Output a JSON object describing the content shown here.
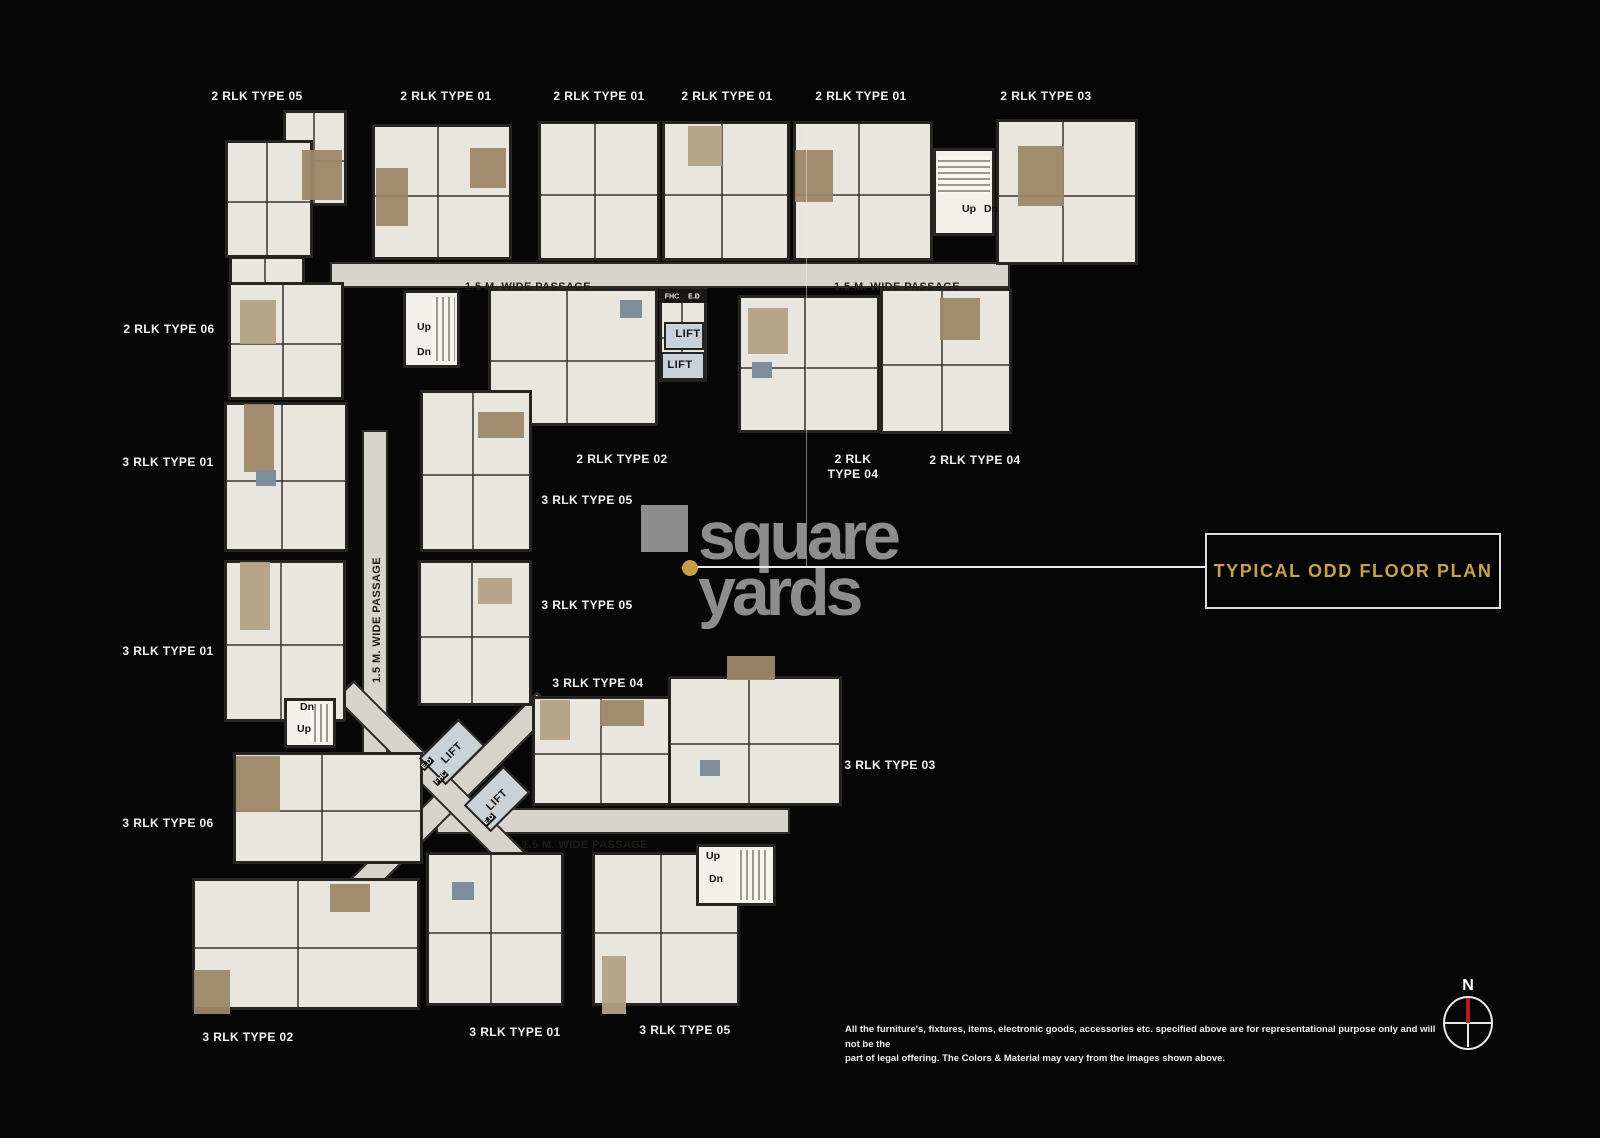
{
  "callout": {
    "title": "TYPICAL ODD FLOOR PLAN"
  },
  "watermark": {
    "word1": "square",
    "word2": "yards"
  },
  "compass": {
    "north_label": "N"
  },
  "disclaimer": {
    "line1": "All the furniture's, fixtures, items, electronic goods, accessories etc. specified above are for representational purpose only and will not be the",
    "line2": "part of legal offering. The Colors & Material may vary from the images shown above."
  },
  "unit_labels": [
    {
      "text": "2 RLK TYPE 05"
    },
    {
      "text": "2 RLK TYPE 01"
    },
    {
      "text": "2 RLK TYPE 01"
    },
    {
      "text": "2 RLK TYPE 01"
    },
    {
      "text": "2 RLK TYPE 01"
    },
    {
      "text": "2 RLK TYPE 03"
    },
    {
      "text": "2 RLK TYPE 06"
    },
    {
      "text": "3 RLK TYPE 01"
    },
    {
      "text": "3 RLK TYPE 01"
    },
    {
      "text": "3 RLK TYPE 06"
    },
    {
      "text": "2 RLK TYPE 02"
    },
    {
      "text": "2 RLK\nTYPE 04"
    },
    {
      "text": "2 RLK TYPE 04"
    },
    {
      "text": "3 RLK TYPE 05"
    },
    {
      "text": "3 RLK TYPE 05"
    },
    {
      "text": "3 RLK TYPE 04"
    },
    {
      "text": "3 RLK TYPE 03"
    },
    {
      "text": "3 RLK TYPE 02"
    },
    {
      "text": "3 RLK TYPE 01"
    },
    {
      "text": "3 RLK TYPE 05"
    }
  ],
  "passage_labels": [
    {
      "text": "1.5 M. WIDE PASSAGE"
    },
    {
      "text": "1.5 M. WIDE PASSAGE"
    },
    {
      "text": "1.5 M. WIDE PASSAGE"
    },
    {
      "text": "1.5 M. WIDE PASSAGE"
    }
  ],
  "core_labels": {
    "lift": "LIFT",
    "fhc": "FHC",
    "ed": "E.D"
  },
  "stair_labels": {
    "up": "Up",
    "dn": "Dn"
  },
  "colors": {
    "accent_gold": "#c7a14b",
    "unit_fill": "#e9e6df",
    "passage_fill": "#d7d4cd",
    "wall": "#262522",
    "watermark_gray": "#8d8d8d",
    "north_red": "#b51c1c"
  }
}
